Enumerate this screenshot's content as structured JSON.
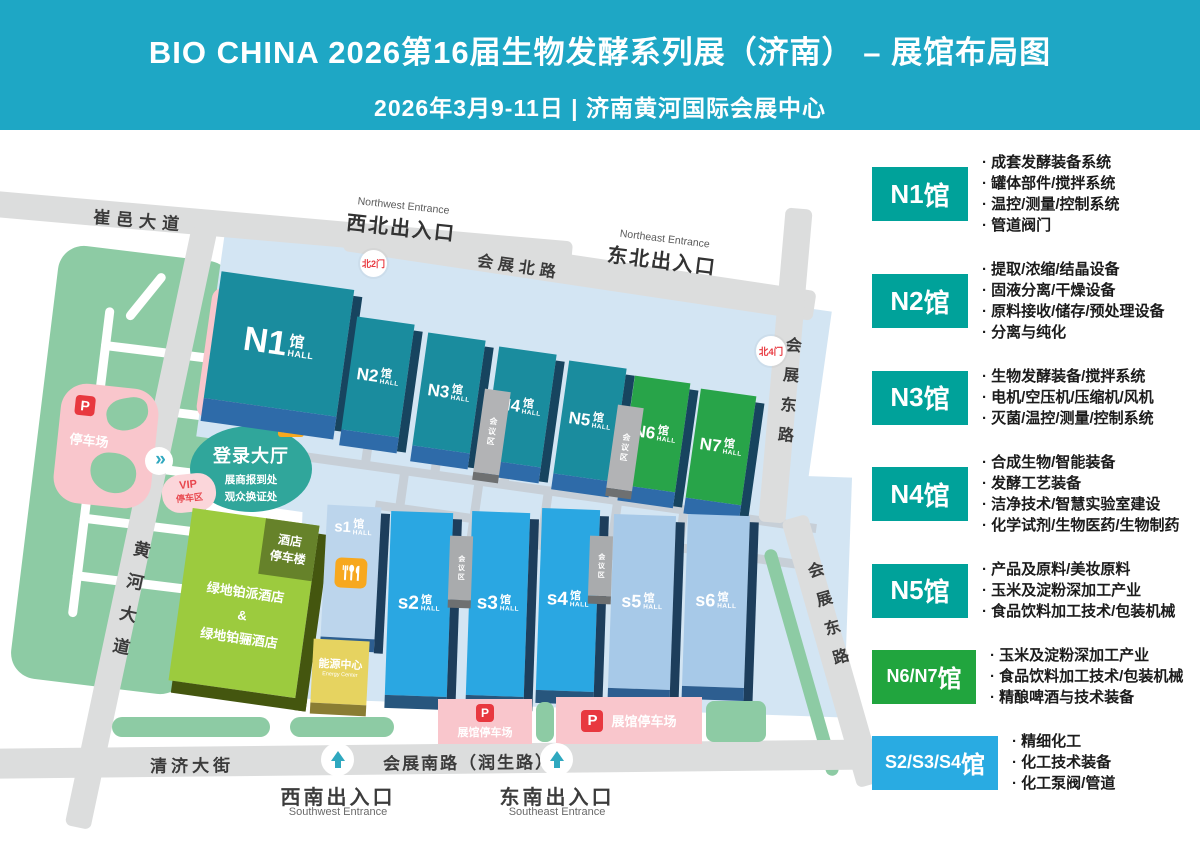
{
  "colors": {
    "header_bg": "#1EA7C5",
    "legend_teal": "#00A29A",
    "legend_green": "#21A53E",
    "legend_blue": "#29ABE2",
    "parking_red": "#E8383F",
    "hall_teal": "#1A8C9E",
    "hall_green": "#28A449",
    "hall_blue": "#2AA7E2"
  },
  "header": {
    "title": "BIO CHINA 2026第16届生物发酵系列展（济南） – 展馆布局图",
    "subtitle": "2026年3月9-11日 | 济南黄河国际会展中心"
  },
  "legend": [
    {
      "prefix": "N1",
      "suffix": "馆",
      "items": [
        "成套发酵装备系统",
        "罐体部件/搅拌系统",
        "温控/测量/控制系统",
        "管道阀门"
      ]
    },
    {
      "prefix": "N2",
      "suffix": "馆",
      "items": [
        "提取/浓缩/结晶设备",
        "固液分离/干燥设备",
        "原料接收/储存/预处理设备",
        "分离与纯化"
      ]
    },
    {
      "prefix": "N3",
      "suffix": "馆",
      "items": [
        "生物发酵装备/搅拌系统",
        "电机/空压机/压缩机/风机",
        "灭菌/温控/测量/控制系统"
      ]
    },
    {
      "prefix": "N4",
      "suffix": "馆",
      "items": [
        "合成生物/智能装备",
        "发酵工艺装备",
        "洁净技术/智慧实验室建设",
        "化学试剂/生物医药/生物制药"
      ]
    },
    {
      "prefix": "N5",
      "suffix": "馆",
      "items": [
        "产品及原料/美妆原料",
        "玉米及淀粉深加工产业",
        "食品饮料加工技术/包装机械"
      ]
    },
    {
      "prefix": "N6/N7",
      "suffix": "馆",
      "items": [
        "玉米及淀粉深加工产业",
        "食品饮料加工技术/包装机械",
        "精酿啤酒与技术装备"
      ]
    },
    {
      "prefix": "S2/S3/S4",
      "suffix": "馆",
      "items": [
        "精细化工",
        "化工技术装备",
        "化工泵阀/管道"
      ]
    }
  ],
  "map": {
    "roads": {
      "cuiyi": "崔邑大道",
      "north": "会展北路",
      "east": "会展东路",
      "west": "黄河大道",
      "qingji": "清济大街",
      "south": "会展南路（润生路）"
    },
    "entrances": {
      "nw": {
        "en": "Northwest Entrance",
        "zh": "西北出入口"
      },
      "ne": {
        "en": "Northeast Entrance",
        "zh": "东北出入口"
      },
      "sw": {
        "zh": "西南出入口",
        "en": "Southwest Entrance"
      },
      "se": {
        "zh": "东南出入口",
        "en": "Southeast Entrance"
      },
      "gate_n2": "北2门",
      "gate_n4": "北4门"
    },
    "halls_north": [
      {
        "name": "N1",
        "suffix": "馆",
        "sub": "HALL"
      },
      {
        "name": "N2",
        "suffix": "馆",
        "sub": "HALL"
      },
      {
        "name": "N3",
        "suffix": "馆",
        "sub": "HALL"
      },
      {
        "name": "N4",
        "suffix": "馆",
        "sub": "HALL"
      },
      {
        "name": "N5",
        "suffix": "馆",
        "sub": "HALL"
      },
      {
        "name": "N6",
        "suffix": "馆",
        "sub": "HALL"
      },
      {
        "name": "N7",
        "suffix": "馆",
        "sub": "HALL"
      }
    ],
    "halls_south": [
      {
        "name": "s1",
        "suffix": "馆",
        "sub": "HALL"
      },
      {
        "name": "s2",
        "suffix": "馆",
        "sub": "HALL"
      },
      {
        "name": "s3",
        "suffix": "馆",
        "sub": "HALL"
      },
      {
        "name": "s4",
        "suffix": "馆",
        "sub": "HALL"
      },
      {
        "name": "s5",
        "suffix": "馆",
        "sub": "HALL"
      },
      {
        "name": "s6",
        "suffix": "馆",
        "sub": "HALL"
      }
    ],
    "meeting_area": "会议区",
    "p": "P",
    "facilities": {
      "login": {
        "title": "登录大厅",
        "line1": "展商报到处",
        "line2": "观众换证处",
        "badge": "咖啡厅"
      },
      "hotel": {
        "corner_line1": "酒店",
        "corner_line2": "停车楼",
        "name1": "绿地铂派酒店",
        "amp": "&",
        "name2": "绿地铂骊酒店"
      },
      "energy": {
        "zh": "能源中心",
        "en": "Energy Center"
      },
      "vip": {
        "line1": "VIP",
        "line2": "停车区"
      },
      "west_parking": "停车场",
      "bus": {
        "line1": "大巴车",
        "line2": "接送点"
      },
      "hall_parking": "展馆停车场"
    }
  }
}
